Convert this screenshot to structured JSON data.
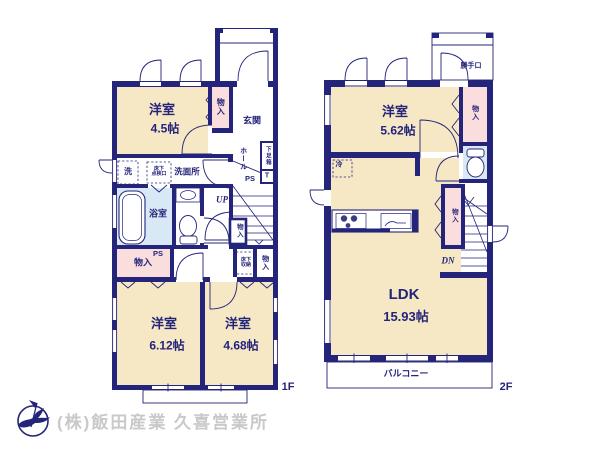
{
  "floor1": {
    "floor_label": "1F",
    "bedroom1": {
      "name": "洋室",
      "size": "4.5帖"
    },
    "bedroom2": {
      "name": "洋室",
      "size": "6.12帖"
    },
    "bedroom3": {
      "name": "洋室",
      "size": "4.68帖"
    },
    "entrance": {
      "label": "玄関"
    },
    "hall": {
      "label": "ホール"
    },
    "shoe_box": {
      "label": "下足箱"
    },
    "toilet_marker": {
      "label": "T"
    },
    "ps_upper": {
      "label": "PS"
    },
    "ps_lower": {
      "label": "PS"
    },
    "washer": {
      "label": "洗"
    },
    "underfloor_hatch": {
      "line1": "床下",
      "line2": "点検口"
    },
    "underfloor_storage": {
      "line1": "床下",
      "line2": "収納"
    },
    "washroom": {
      "label": "洗面所"
    },
    "bathroom": {
      "label": "浴室"
    },
    "stairs": {
      "label": "UP"
    },
    "closet_upper": {
      "label": "物入"
    },
    "closet_stairs": {
      "label": "物入"
    },
    "closet_left": {
      "label": "物入"
    },
    "closet_right": {
      "label": "物入"
    }
  },
  "floor2": {
    "floor_label": "2F",
    "bedroom": {
      "name": "洋室",
      "size": "5.62帖"
    },
    "ldk": {
      "name": "LDK",
      "size": "15.93帖"
    },
    "back_door": {
      "label": "勝手口"
    },
    "closet_top": {
      "label": "物入"
    },
    "closet_mid": {
      "label": "物入"
    },
    "fridge": {
      "label": "冷"
    },
    "stairs": {
      "label": "DN"
    },
    "balcony": {
      "label": "バルコニー"
    }
  },
  "footer": {
    "company": "(株)飯田産業 久喜営業所"
  },
  "colors": {
    "wall_navy": "#24247b",
    "room_cream": "#f6e8c4",
    "closet_pink": "#fadedd",
    "wet_blue": "#d9e8f5",
    "footer_gray": "#c9c9c9"
  }
}
